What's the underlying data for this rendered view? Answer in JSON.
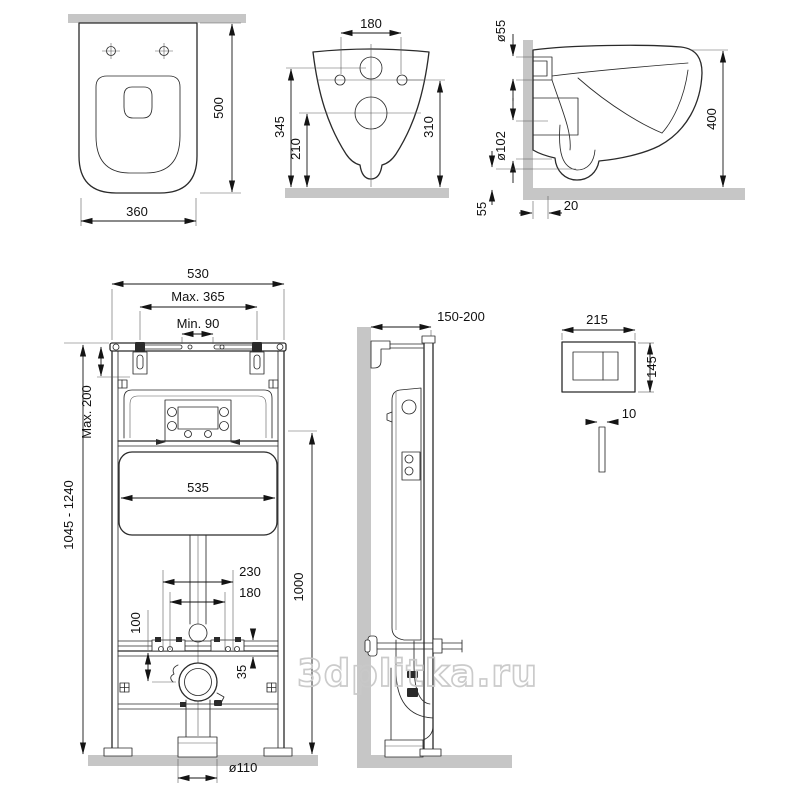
{
  "watermark": {
    "text": "3dplitka.ru"
  },
  "colors": {
    "line": "#2a2a2a",
    "surface_gray": "#c6c6c6",
    "watermark_gray": "#c9c9c9",
    "background": "#ffffff"
  },
  "views": {
    "toilet_top": {
      "depth": "500",
      "width": "360"
    },
    "toilet_back": {
      "hole_spacing": "180",
      "inlet_height": "345",
      "drain_height": "210",
      "hole_height": "310"
    },
    "toilet_side": {
      "inlet_dia": "ø55",
      "drain_dia": "ø102",
      "height": "400",
      "bottom_gap": "55",
      "wall_gap": "20"
    },
    "frame_front": {
      "width": "530",
      "stud_spacing_max": "Max. 365",
      "gap_min": "Min. 90",
      "top_adjust": "Max. 200",
      "height_range": "1045 - 1240",
      "tank_width": "535",
      "spacing_outer": "230",
      "spacing_inner": "180",
      "drain_offset": "100",
      "bowl_height": "1000",
      "rail_height": "35",
      "outlet_dia": "ø110"
    },
    "frame_side": {
      "wall_distance": "150-200"
    },
    "flush_plate": {
      "width": "215",
      "height": "145",
      "thickness": "10"
    }
  }
}
